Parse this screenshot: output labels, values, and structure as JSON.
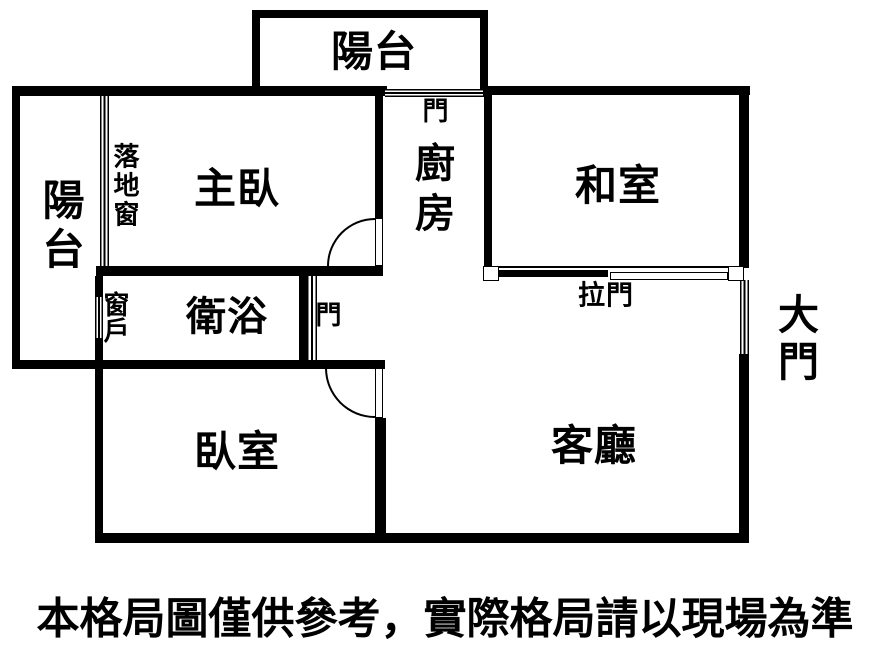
{
  "plan": {
    "rooms": {
      "balcony_top": "陽台",
      "balcony_left": "陽台",
      "master_bedroom": "主臥",
      "kitchen": "廚房",
      "washitsu": "和室",
      "bathroom": "衛浴",
      "bedroom": "臥室",
      "living_room": "客廳"
    },
    "features": {
      "floor_window": "落地窗",
      "window": "窗戶",
      "door_kitchen_balcony": "門",
      "door_bathroom": "門",
      "sliding_door": "拉門",
      "main_door": "大門"
    },
    "colors": {
      "wall": "#000000",
      "background": "#ffffff"
    }
  },
  "footer": {
    "disclaimer": "本格局圖僅供參考，實際格局請以現場為準"
  }
}
